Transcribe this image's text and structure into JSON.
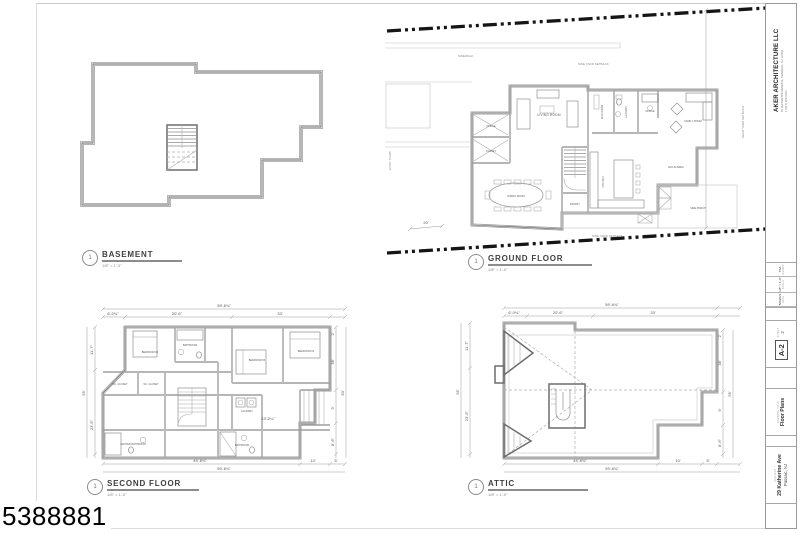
{
  "sheet": {
    "id": "5388881"
  },
  "titleblock": {
    "firm_name": "AKER ARCHITECTURE LLC",
    "firm_address": "65 JEFFERSON AVENUE, TEANECK, N.J. 07666",
    "firm_phone": "T (917) 254-5023",
    "fields": [
      {
        "label": "DATE",
        "value": "5/8/2021"
      },
      {
        "label": "SCALE",
        "value": "1/8\" = 1'-0\""
      },
      {
        "label": "DRAWN",
        "value": "TSA"
      }
    ],
    "sheet_label": "SHEET",
    "sheet_number": "A-2",
    "sheet_seq": "2",
    "drawing_title_label": "DRAWING TITLE",
    "drawing_title": "Floor Plans",
    "project_label": "PROJECT",
    "project_address1": "29 Katherine Ave",
    "project_address2": "Passaic, NJ"
  },
  "plans": {
    "basement": {
      "num": "1",
      "title": "BASEMENT",
      "scale": "1/8\" = 1'-0\""
    },
    "ground": {
      "num": "1",
      "title": "GROUND FLOOR",
      "scale": "1/8\" = 1'-0\"",
      "rooms": [
        "LIVING ROOM",
        "DINING ROOM",
        "KITCHEN",
        "PANTRY",
        "MUD ROOM",
        "LAUNDRY",
        "OFFICE",
        "FAMILY ROOM",
        "EAT-IN AREA",
        "SIDE PORCH",
        "OFFICE",
        "CLOSET"
      ],
      "site": {
        "sidewalk": "SIDEWALK",
        "curb": "EXIST. CURB",
        "setback_top": "SIDE YARD SETBACK",
        "setback_bottom": "SIDE YARD SETBACK",
        "setback_right": "REAR YARD SETBACK",
        "front_dim": "20'"
      }
    },
    "second": {
      "num": "1",
      "title": "SECOND FLOOR",
      "scale": "1/8\" = 1'-0\"",
      "rooms": [
        "BEDROOM #2",
        "BATHROOM",
        "BEDROOM #3",
        "BEDROOM #1",
        "W.I. CLOSET",
        "W.I. CLOSET",
        "MASTER BATHROOM",
        "LAUNDRY",
        "BATHROOM"
      ],
      "dims": {
        "overall_top": "59'-6¾\"",
        "top": [
          "6'-0¾\"",
          "20'-6\"",
          "33'"
        ],
        "left": [
          "11'-7\"",
          "55'",
          "23'-5\""
        ],
        "right": [
          "2'",
          "38'",
          "9'",
          "8'-6\""
        ],
        "overall_right": "50'",
        "bottom": [
          "44'-6¾\"",
          "10'",
          "5'"
        ],
        "overall_bottom": "59'-6¾\"",
        "interior": "13'-2¼\""
      }
    },
    "attic": {
      "num": "1",
      "title": "ATTIC",
      "scale": "1/8\" = 1'-0\"",
      "dims": {
        "overall_top": "59'-6¾\"",
        "top": [
          "6'-0¾\"",
          "20'-6\"",
          "33'"
        ],
        "left": [
          "11'-7\"",
          "55'",
          "23'-5\""
        ],
        "right": [
          "2'",
          "38'",
          "9'",
          "8'-6\""
        ],
        "overall_right": "55'",
        "bottom": [
          "44'-6¾\"",
          "10'",
          "5'"
        ],
        "overall_bottom": "59'-6¾\""
      }
    }
  }
}
